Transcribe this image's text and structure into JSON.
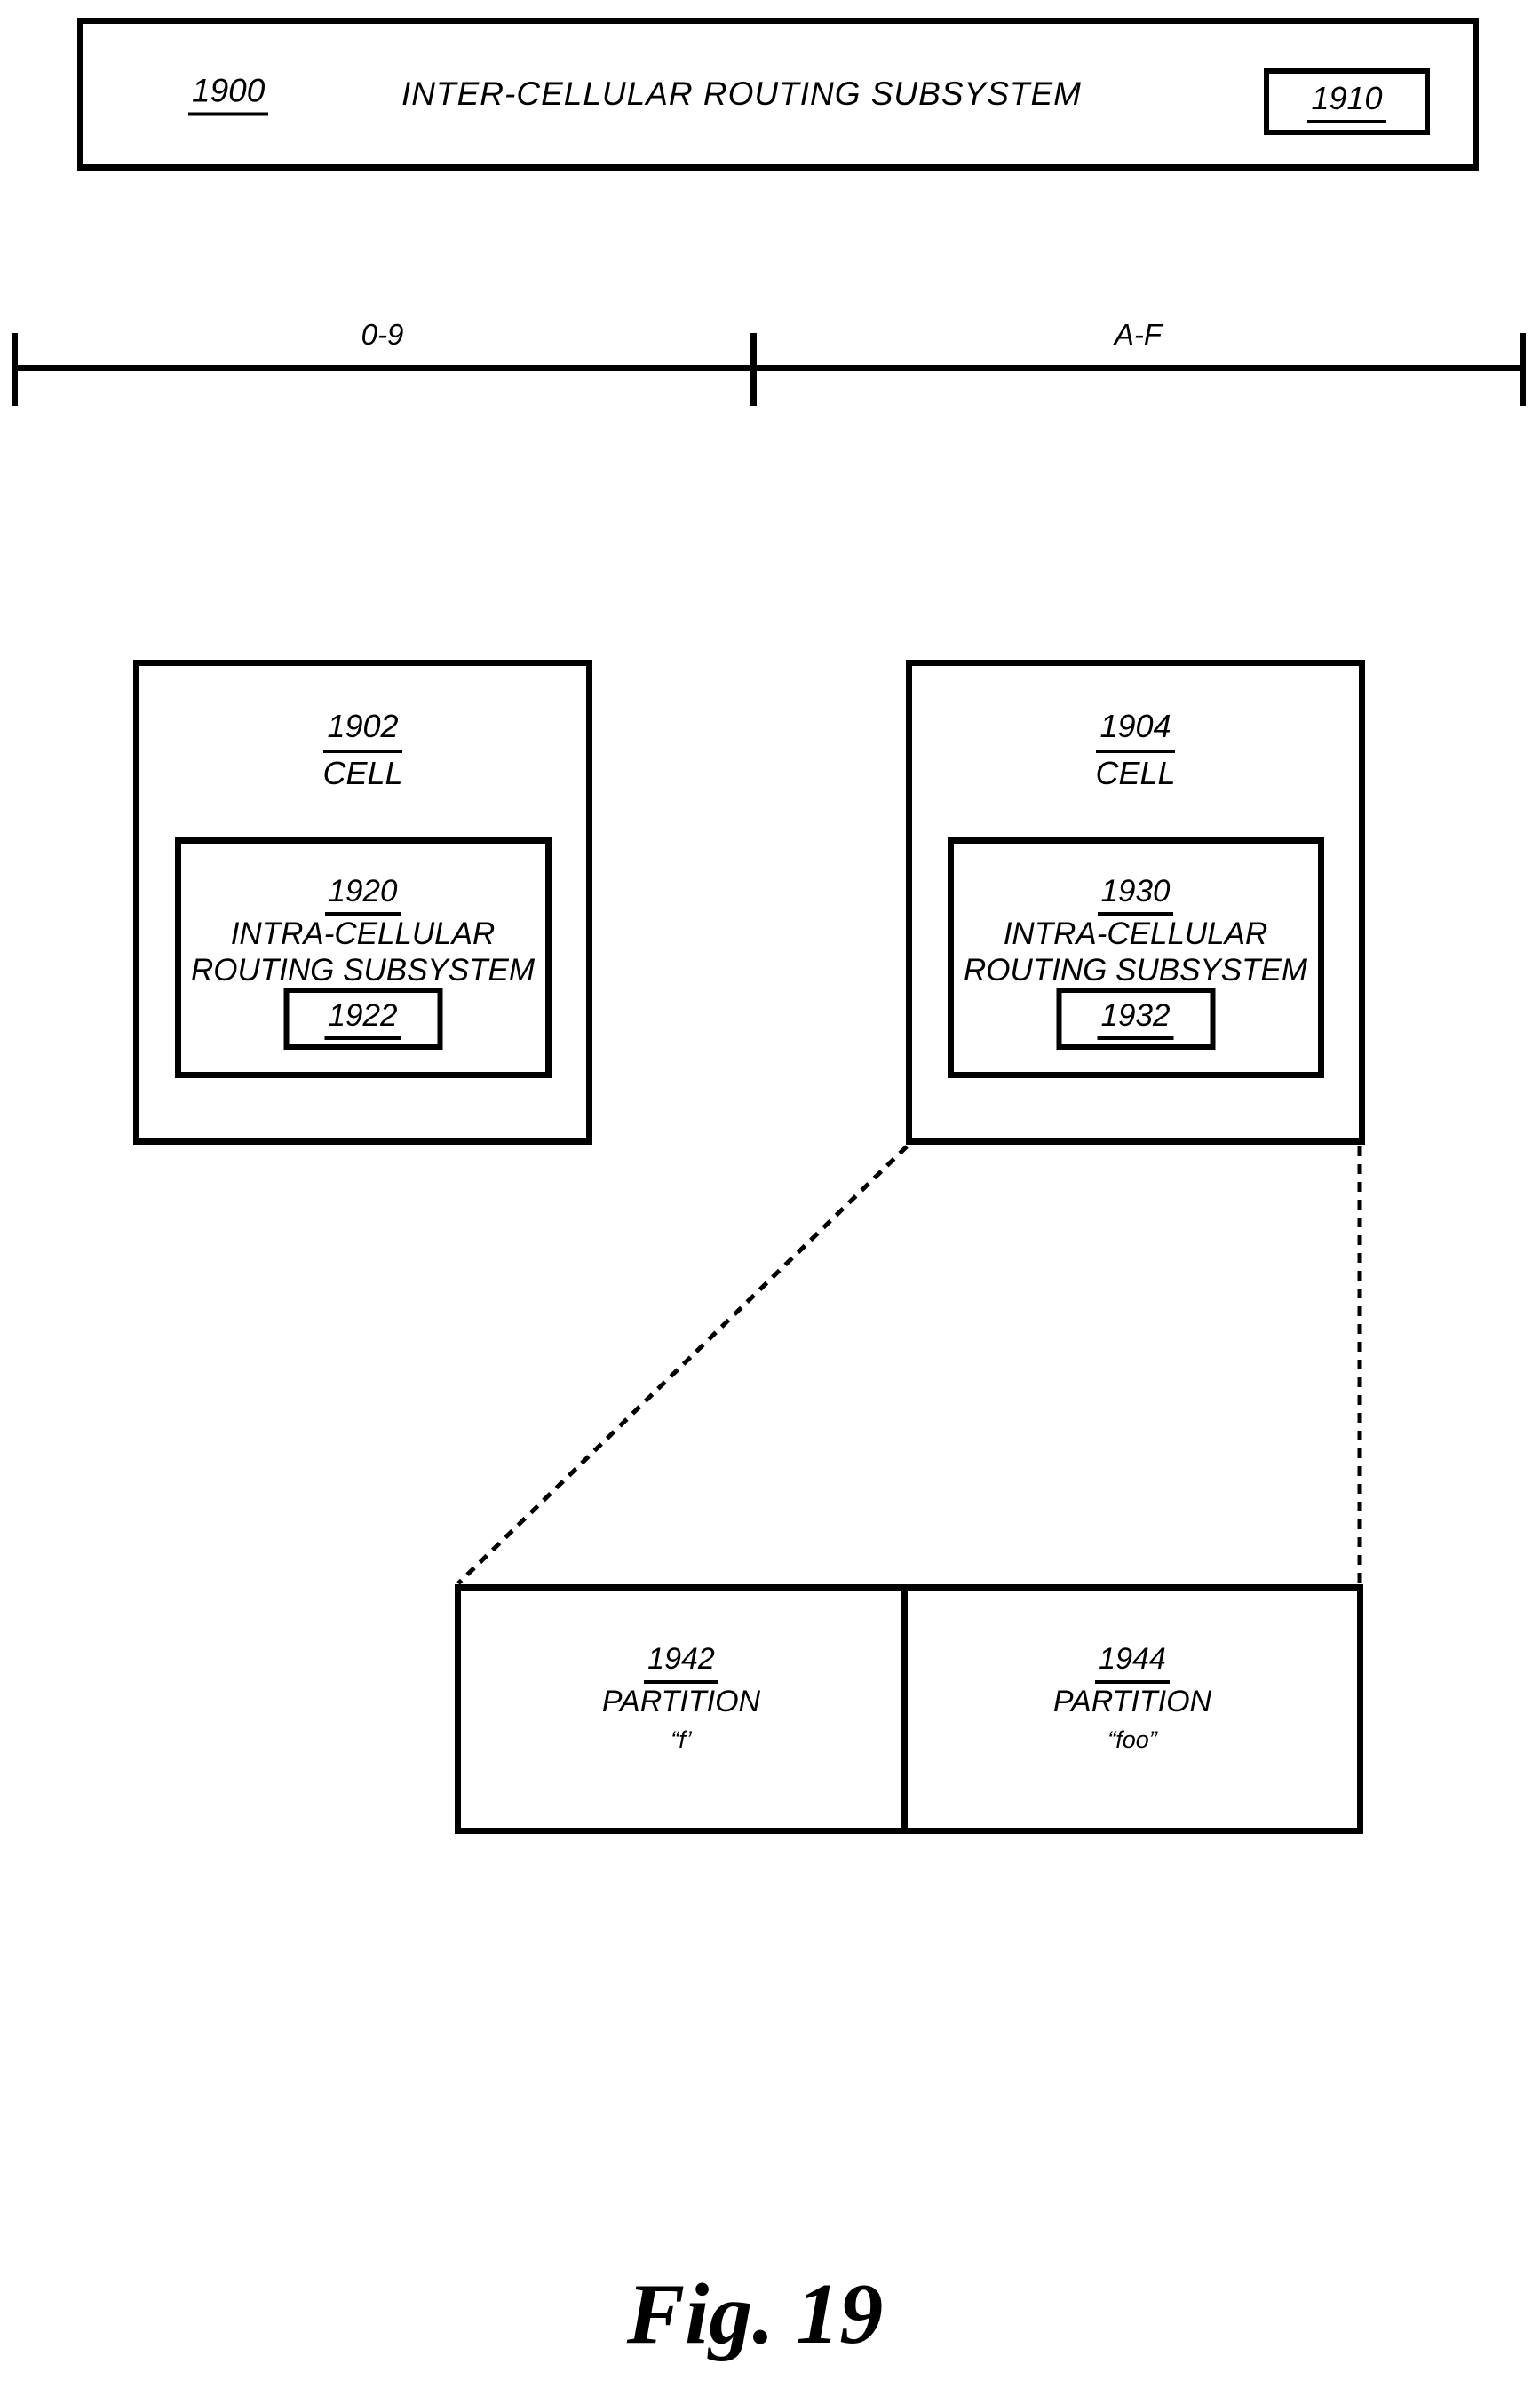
{
  "top_box": {
    "ref": "1900",
    "title": "INTER-CELLULAR ROUTING SUBSYSTEM",
    "badge_ref": "1910"
  },
  "scale": {
    "segments": [
      {
        "label": "0-9"
      },
      {
        "label": "A-F"
      }
    ]
  },
  "cells": [
    {
      "ref": "1902",
      "label": "CELL",
      "subsystem": {
        "ref": "1920",
        "name_line1": "INTRA-CELLULAR",
        "name_line2": "ROUTING SUBSYSTEM",
        "router_ref": "1922"
      }
    },
    {
      "ref": "1904",
      "label": "CELL",
      "subsystem": {
        "ref": "1930",
        "name_line1": "INTRA-CELLULAR",
        "name_line2": "ROUTING SUBSYSTEM",
        "router_ref": "1932"
      }
    }
  ],
  "partitions": [
    {
      "ref": "1942",
      "label": "PARTITION",
      "name": "“f’"
    },
    {
      "ref": "1944",
      "label": "PARTITION",
      "name": "“foo”"
    }
  ],
  "figure": {
    "caption": "Fig. 19"
  },
  "colors": {
    "ink": "#000000",
    "paper": "#ffffff"
  }
}
